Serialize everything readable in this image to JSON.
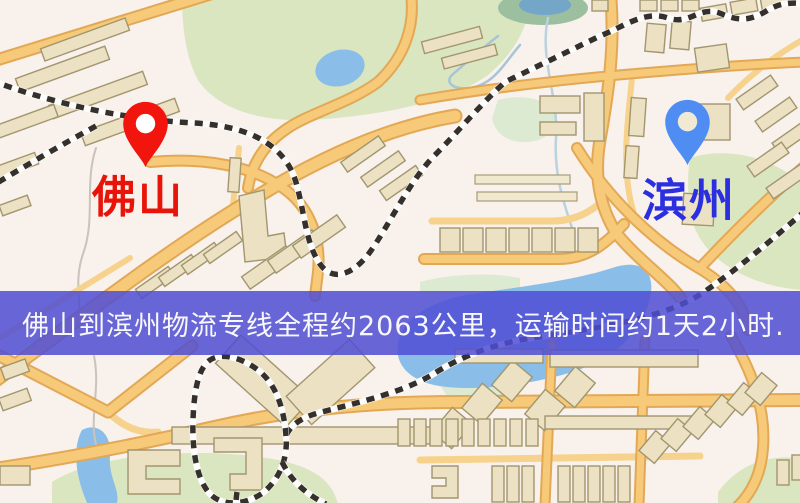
{
  "map": {
    "origin": {
      "label": "佛山",
      "label_color": "#e8140a",
      "pin_color": "#f2150d",
      "pin_hole_color": "#ffffff"
    },
    "destination": {
      "label": "滨州",
      "label_color": "#2b2fe0",
      "pin_color": "#4f8df2",
      "pin_hole_color": "#f1e9d2"
    },
    "banner": {
      "text": "佛山到滨州物流专线全程约2063公里，运输时间约1天2小时.",
      "background": "rgba(79,77,212,0.85)",
      "accent_hex": "#4f4dd4",
      "text_color": "#f8f8fa"
    },
    "palette": {
      "map_background": "#f8f1ec",
      "road_fill": "#f7ca79",
      "road_casing": "#e2a855",
      "minor_road": "#f6d28c",
      "water": "#8abde8",
      "park_green": "#d9e6c0",
      "building": "#ece2c3",
      "railway_dash": "#35302b"
    }
  }
}
